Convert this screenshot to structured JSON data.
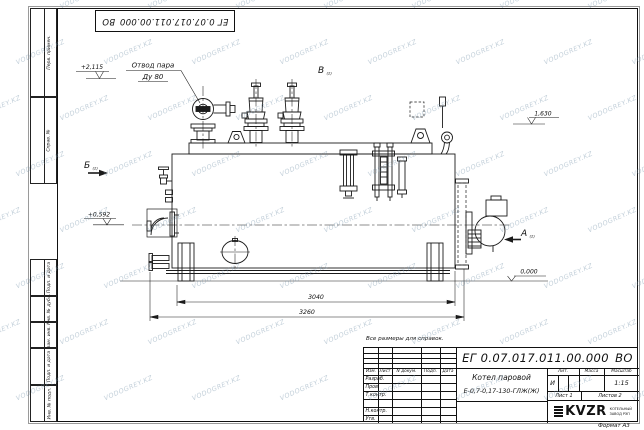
{
  "sheet": {
    "watermark": "VODOGREY.KZ",
    "note": "Все размеры для справок.",
    "format_label": "Формат А3"
  },
  "frame": {
    "top_stamp": "ЕГ 0.07.017.011.00.000 ВО",
    "left_labels": [
      "Перв. примен.",
      "Справ. №",
      "Подп. и дата",
      "Инв. № дубл.",
      "Взам. инв. №",
      "Подп. и дата",
      "Инв. № подл."
    ]
  },
  "title_block": {
    "doc_number": "ЕГ 0.07.017.011.00.000 ВО",
    "name_line1": "Котел паровой",
    "name_line2": "Е-0,7-0,17-130-ГЛЖ(Ж)",
    "col_izm": "Изм.",
    "col_list": "Лист",
    "col_doc": "N докум.",
    "col_sign": "Подп.",
    "col_date": "Дата",
    "roles": [
      "Разраб.",
      "Пров.",
      "Т.контр.",
      "",
      "Н.контр.",
      "Утв."
    ],
    "lit_header": "Лит.",
    "mass_header": "Масса",
    "scale_header": "Масштаб",
    "lit_value": "И",
    "scale_value": "1:15",
    "sheet_info": "Лист 1",
    "sheets_info": "Листов 2",
    "logo_text": "KVZR",
    "logo_caption_1": "КОТЕЛЬНЫЙ",
    "logo_caption_2": "ЗАВОД РЭП"
  },
  "annotations": {
    "steam_outlet_1": "Отвод пара",
    "steam_outlet_2": "Ду 80",
    "view_a": "А",
    "view_b": "Б",
    "view_v": "В",
    "view_ref": "(2)",
    "elev_top": "+2,115",
    "elev_mid": "+0,592",
    "elev_right": "1,630",
    "elev_zero": "0,000",
    "dim_inner": "3040",
    "dim_overall": "3260"
  }
}
